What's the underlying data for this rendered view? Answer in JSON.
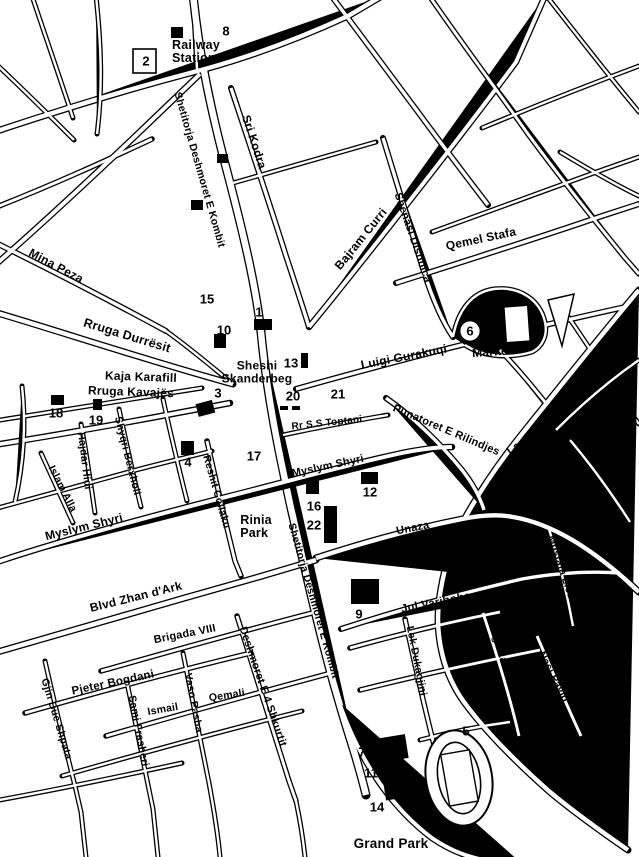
{
  "map": {
    "title": "Tirana city centre street map",
    "colors": {
      "ink": "#000000",
      "paper": "#ffffff"
    },
    "places": {
      "railway_station": {
        "line1": "Railway",
        "line2": "Station"
      },
      "sheshi_skanderbeg": {
        "line1": "Sheshi",
        "line2": "Skanderbeg"
      },
      "rinia_park": {
        "line1": "Rinia",
        "line2": "Park"
      },
      "market": "Market",
      "grand_park": "Grand Park"
    },
    "streets": {
      "shetitorja_n": "Shetitorja Deshmoret E Kombit",
      "shetitorja_s": "Shetitorja Deshmoret E Kombit",
      "sri_kodra": "Sri Kodra",
      "bajram_curri": "Bajram Curri",
      "shenasi_dishnica": "Shenasi Dishnica",
      "qemel_stafa": "Qemel Stafa",
      "mina_peza": "Mina Peza",
      "rruga_durresit": "Rruga Durrësit",
      "luigi_gurakuqi": "Luigi Gurakuqi",
      "kaja_karafill": "Kaja Karafill",
      "rruga_kavajes": "Rruga Kavajës",
      "rr_ss_toptani": "Rr S.S Toptani",
      "punatoret": "Punatoret E Rilindjes",
      "lana_river": "Lana River",
      "hajdar_hidi": "Hajdar Hidi",
      "shyqri_berxholi": "Shyqri Berxholi",
      "islam_alla": "Islam Alla",
      "myslym_shyri_west": "Myslym Shyri",
      "myslym_shyri_center": "Myslym Shyri",
      "reshit_collaku": "Reshit Collaku",
      "unaza": "Unaza",
      "mustafa_lleshi": "Mustafa Lleshi",
      "blvd_zhan_dark": "Blvd Zhan d'Ark",
      "jul_variboba": "Jul Variboba",
      "brigada_viii": "Brigada VIII",
      "deshmoret_4_shkurtit": "Deshmoret E 4 Shkurtit",
      "pjeter_bogdani": "Pjeter Bogdani",
      "gjin_bue_shpata": "Gjin Bue Shpata",
      "sami_frasheri": "Sami Frasheri",
      "ismail": "Ismail",
      "vaso_pasha": "Vaso Pasha",
      "qemali": "Qemali",
      "lek_dukagjini": "Lek Dukagjini",
      "rruga_labinoti": "Rruga Labinoti",
      "nasi_pavlo": "Nasi Pavlo"
    },
    "numbers": {
      "n1": "1",
      "n2": "2",
      "n3": "3",
      "n4": "4",
      "n5": "5",
      "n6": "6",
      "n7": "7",
      "n8": "8",
      "n9": "9",
      "n10": "10",
      "n11": "11",
      "n12": "12",
      "n13": "13",
      "n14": "14",
      "n15": "15",
      "n16": "16",
      "n17": "17",
      "n18": "18",
      "n19": "19",
      "n20": "20",
      "n21": "21",
      "n22": "22"
    }
  }
}
